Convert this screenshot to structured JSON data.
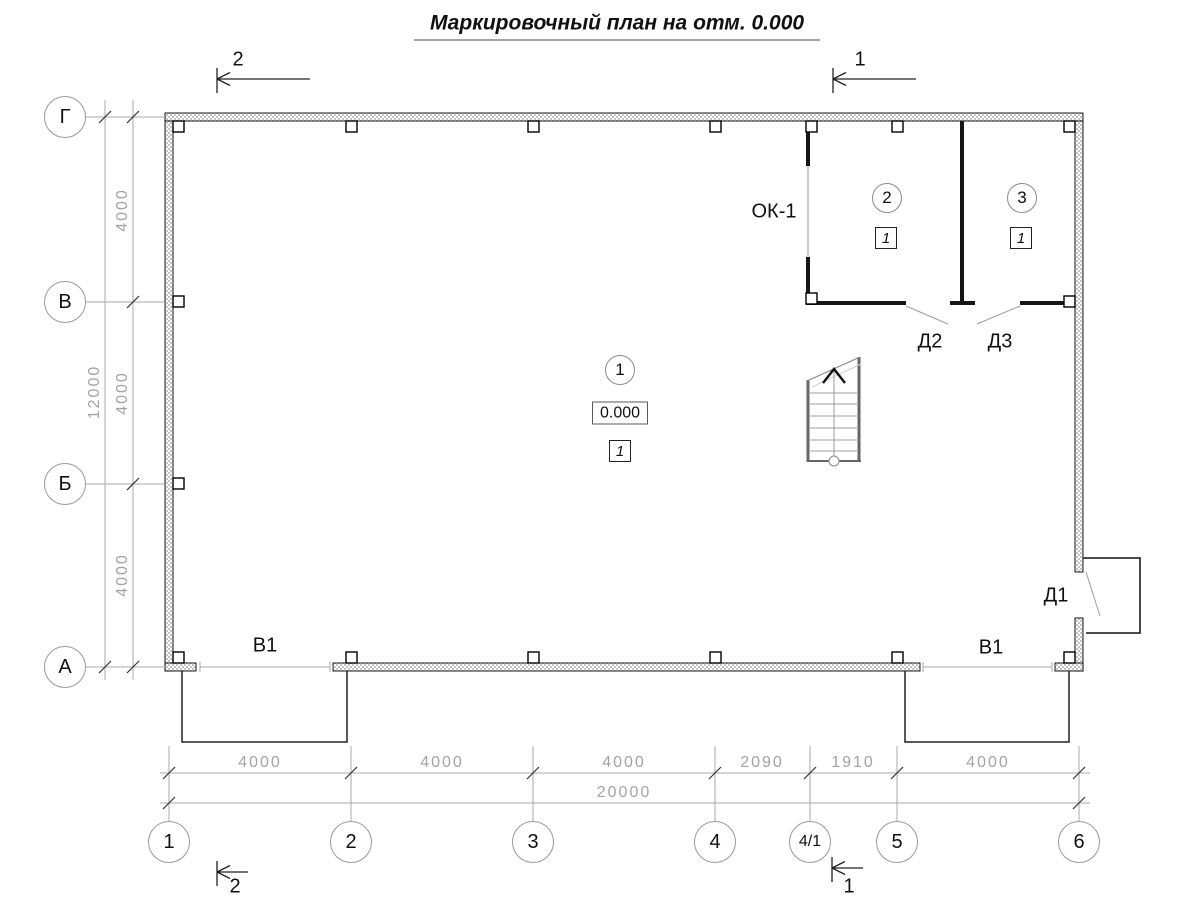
{
  "title": "Маркировочный план на отм. 0.000",
  "colors": {
    "line": "#1a1a1a",
    "dim_gray": "#a3a3a3",
    "wall_hatch": "#c4c4c4"
  },
  "section_marks": {
    "top_left": "2",
    "top_right": "1",
    "bottom_left": "2",
    "bottom_right": "1"
  },
  "axes": {
    "vertical": [
      "Г",
      "В",
      "Б",
      "А"
    ],
    "horizontal": [
      "1",
      "2",
      "3",
      "4",
      "4/1",
      "5",
      "6"
    ]
  },
  "dimensions": {
    "bottom_segments": [
      "4000",
      "4000",
      "4000",
      "2090",
      "1910",
      "4000"
    ],
    "bottom_total": "20000",
    "left_segments": [
      "4000",
      "4000",
      "4000"
    ],
    "left_total": "12000"
  },
  "marks": {
    "window": "ОК-1",
    "door1": "Д1",
    "door2": "Д2",
    "door3": "Д3",
    "gate_left": "В1",
    "gate_right": "В1"
  },
  "rooms": {
    "room1": {
      "number": "1",
      "elevation": "0.000",
      "floor_type": "1"
    },
    "room2": {
      "number": "2",
      "floor_type": "1"
    },
    "room3": {
      "number": "3",
      "floor_type": "1"
    }
  }
}
